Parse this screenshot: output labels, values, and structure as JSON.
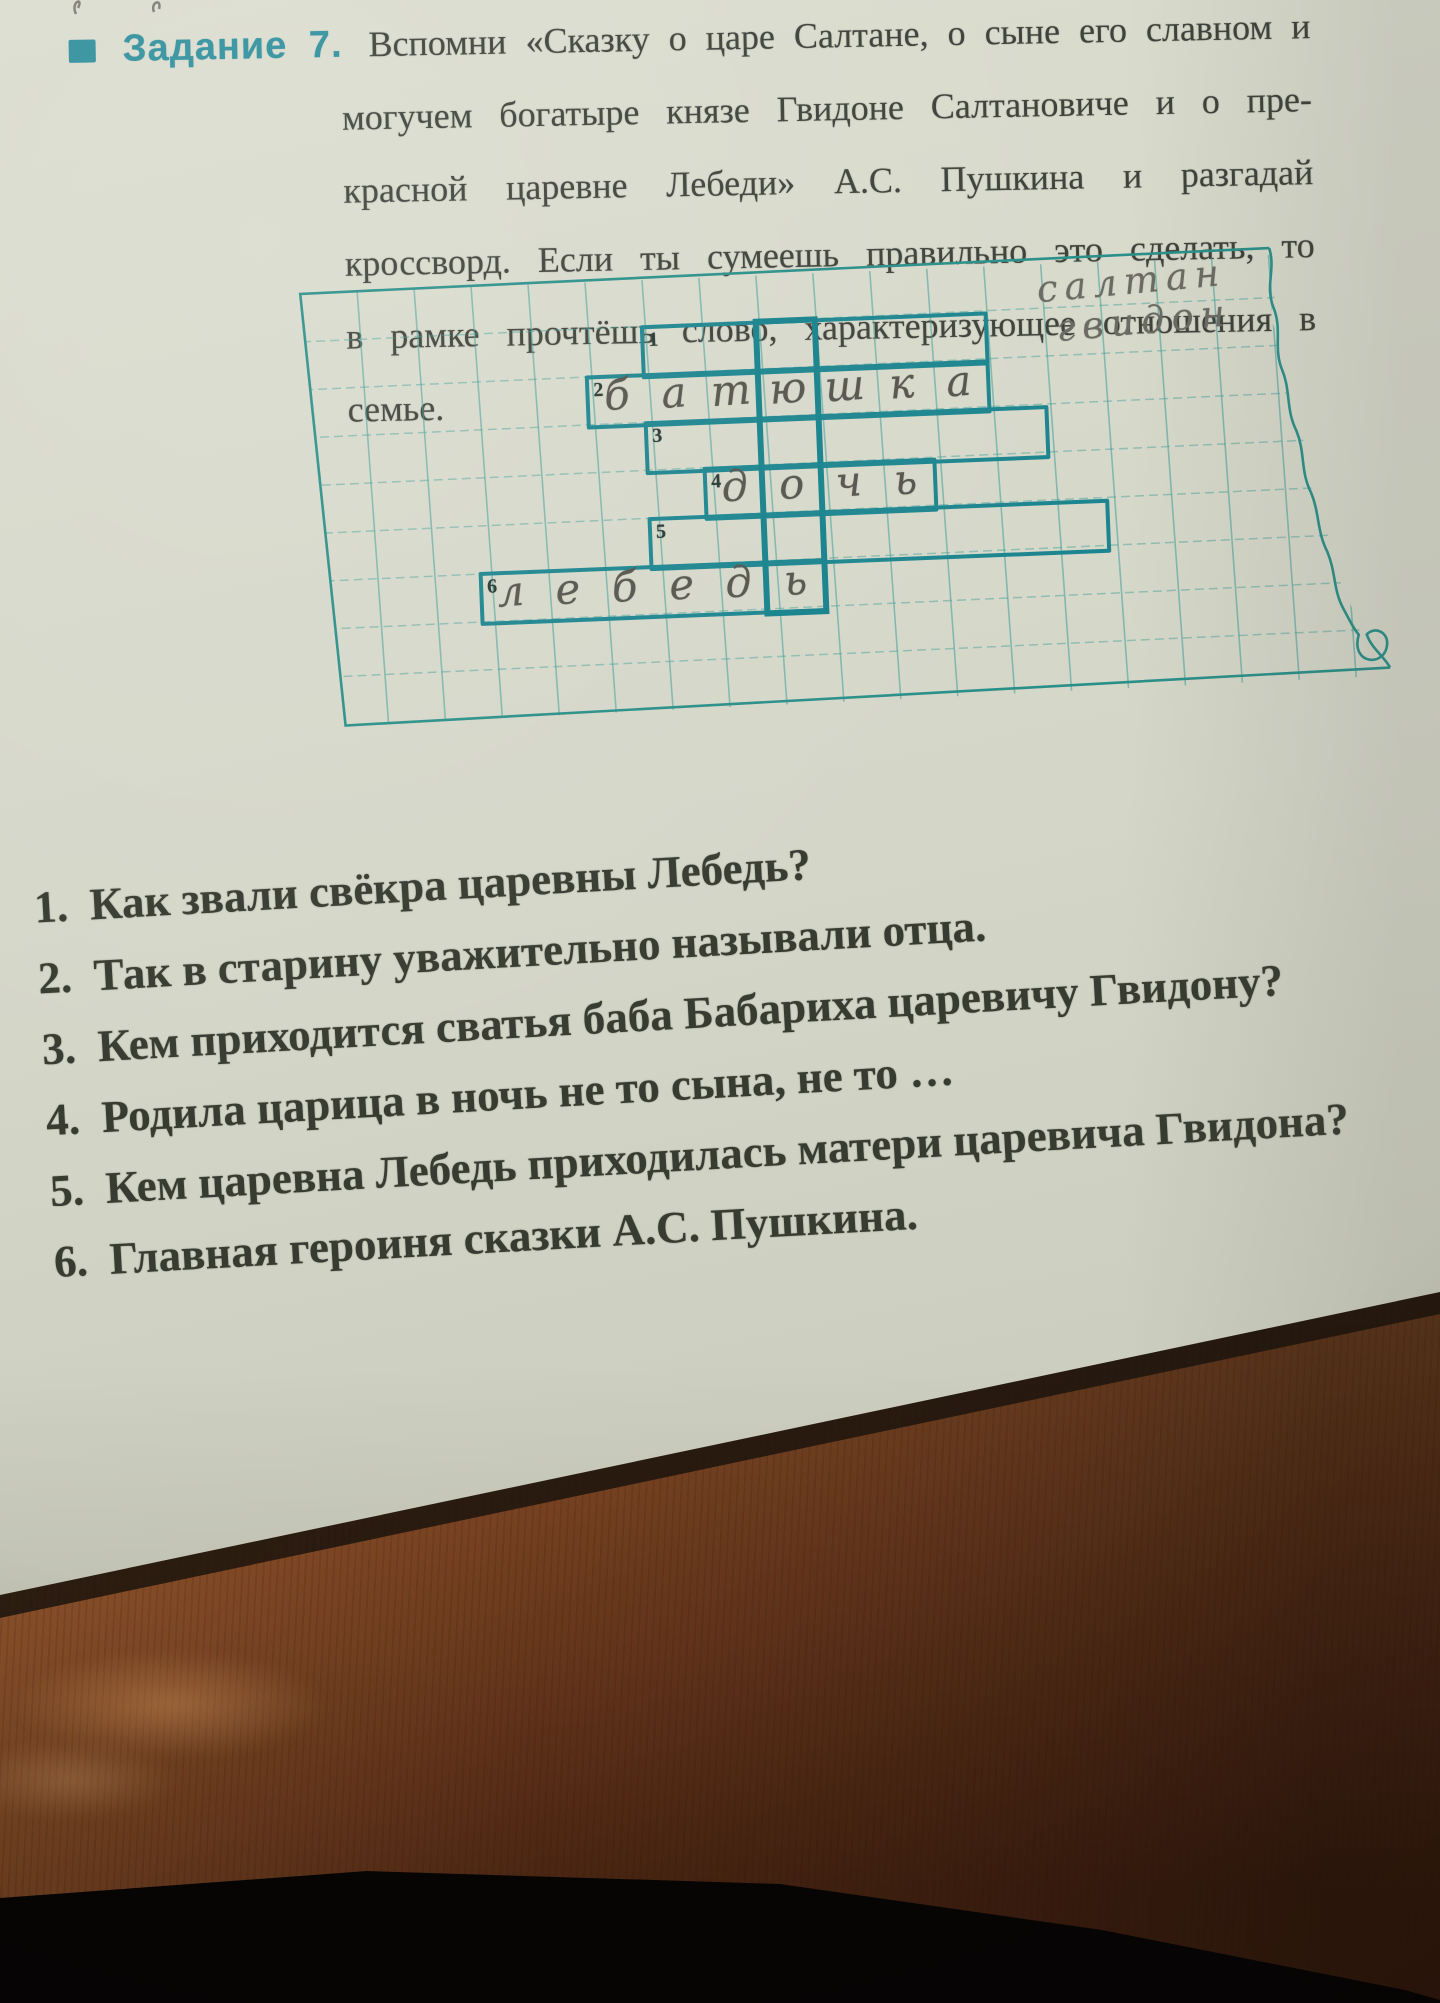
{
  "photo": {
    "paper_color": "#d5d7c9",
    "accent_teal": "#2f8f9c",
    "crossword_pen_color": "#1d858f",
    "pencil_color": "#64645d",
    "wood_light": "#94582d",
    "wood_dark": "#4e2713"
  },
  "header": {
    "bullet_icon": "square-bullet",
    "label": "Задание 7.",
    "lines": [
      "Вспомни «Сказку о царе Салтане, о сыне его славном и",
      "могучем богатыре князе Гвидоне Салтановиче и о пре-",
      "красной царевне Лебеди» А.С. Пушкина и разгадай",
      "кроссворд. Если ты сумеешь правильно это сделать, то",
      "в рамке прочтёшь слово, характеризующее отношения в",
      "семье."
    ]
  },
  "crossword": {
    "framed_column": 5,
    "rows": [
      {
        "num": "1",
        "start": 3,
        "len": 6,
        "letters": ""
      },
      {
        "num": "2",
        "start": 2,
        "len": 7,
        "letters": "батюшка"
      },
      {
        "num": "3",
        "start": 3,
        "len": 7,
        "letters": ""
      },
      {
        "num": "4",
        "start": 4,
        "len": 4,
        "letters": "дочь"
      },
      {
        "num": "5",
        "start": 3,
        "len": 8,
        "letters": ""
      },
      {
        "num": "6",
        "start": 0,
        "len": 6,
        "letters": "лебедь"
      }
    ],
    "pencil_notes": [
      "салтан",
      "гвидон"
    ]
  },
  "questions": [
    {
      "num": "1.",
      "text": "Как звали свёкра царевны Лебедь?"
    },
    {
      "num": "2.",
      "text": "Так в старину уважительно называли отца."
    },
    {
      "num": "3.",
      "text": "Кем приходится сватья баба Бабариха царевичу Гвидону?"
    },
    {
      "num": "4.",
      "text": "Родила царица в ночь не то сына, не то …"
    },
    {
      "num": "5.",
      "text": "Кем царевна Лебедь приходилась матери царевича Гвидона?"
    },
    {
      "num": "6.",
      "text": "Главная героиня сказки А.С. Пушкина."
    }
  ]
}
